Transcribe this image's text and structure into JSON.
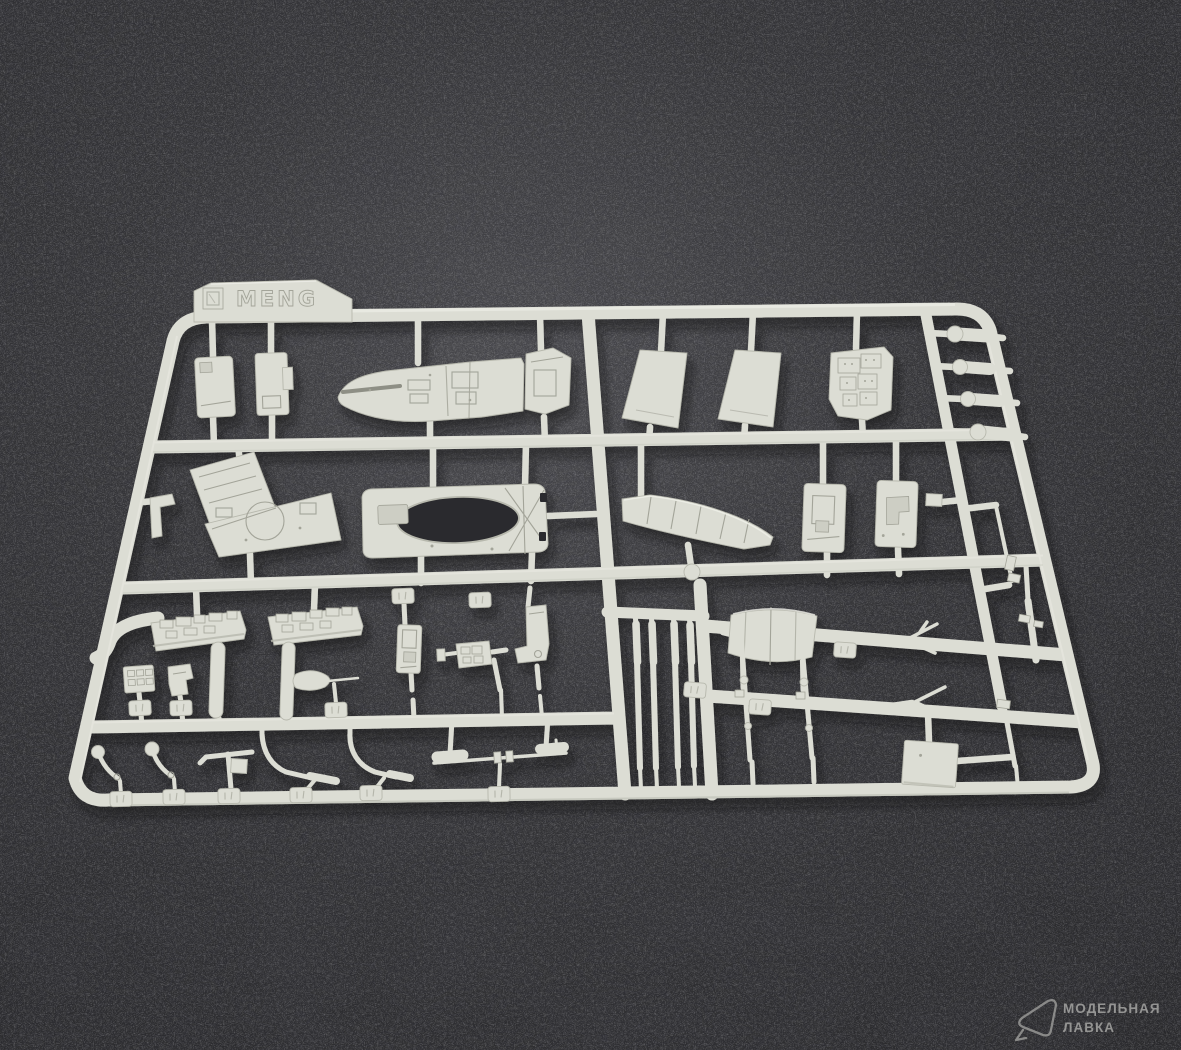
{
  "photo": {
    "alt": "Light grey injection-molded plastic model kit sprue with many small aircraft parts, photographed on dark charcoal carpet"
  },
  "sprue": {
    "brand_text": "MENG"
  },
  "watermark": {
    "line1": "МОДЕЛЬНАЯ",
    "line2": "ЛАВКА"
  },
  "colors": {
    "carpet": "#343437",
    "carpet_light": "#4b4b4f",
    "carpet_dark": "#29292c",
    "plastic": "#dcddd4",
    "plastic_hi": "#edeee7",
    "plastic_shade": "#b7b8ad",
    "engrave": "#a3a499",
    "hole": "#2b2b2d",
    "recess": "#cdcec4",
    "watermark": "#a5a5a3"
  }
}
